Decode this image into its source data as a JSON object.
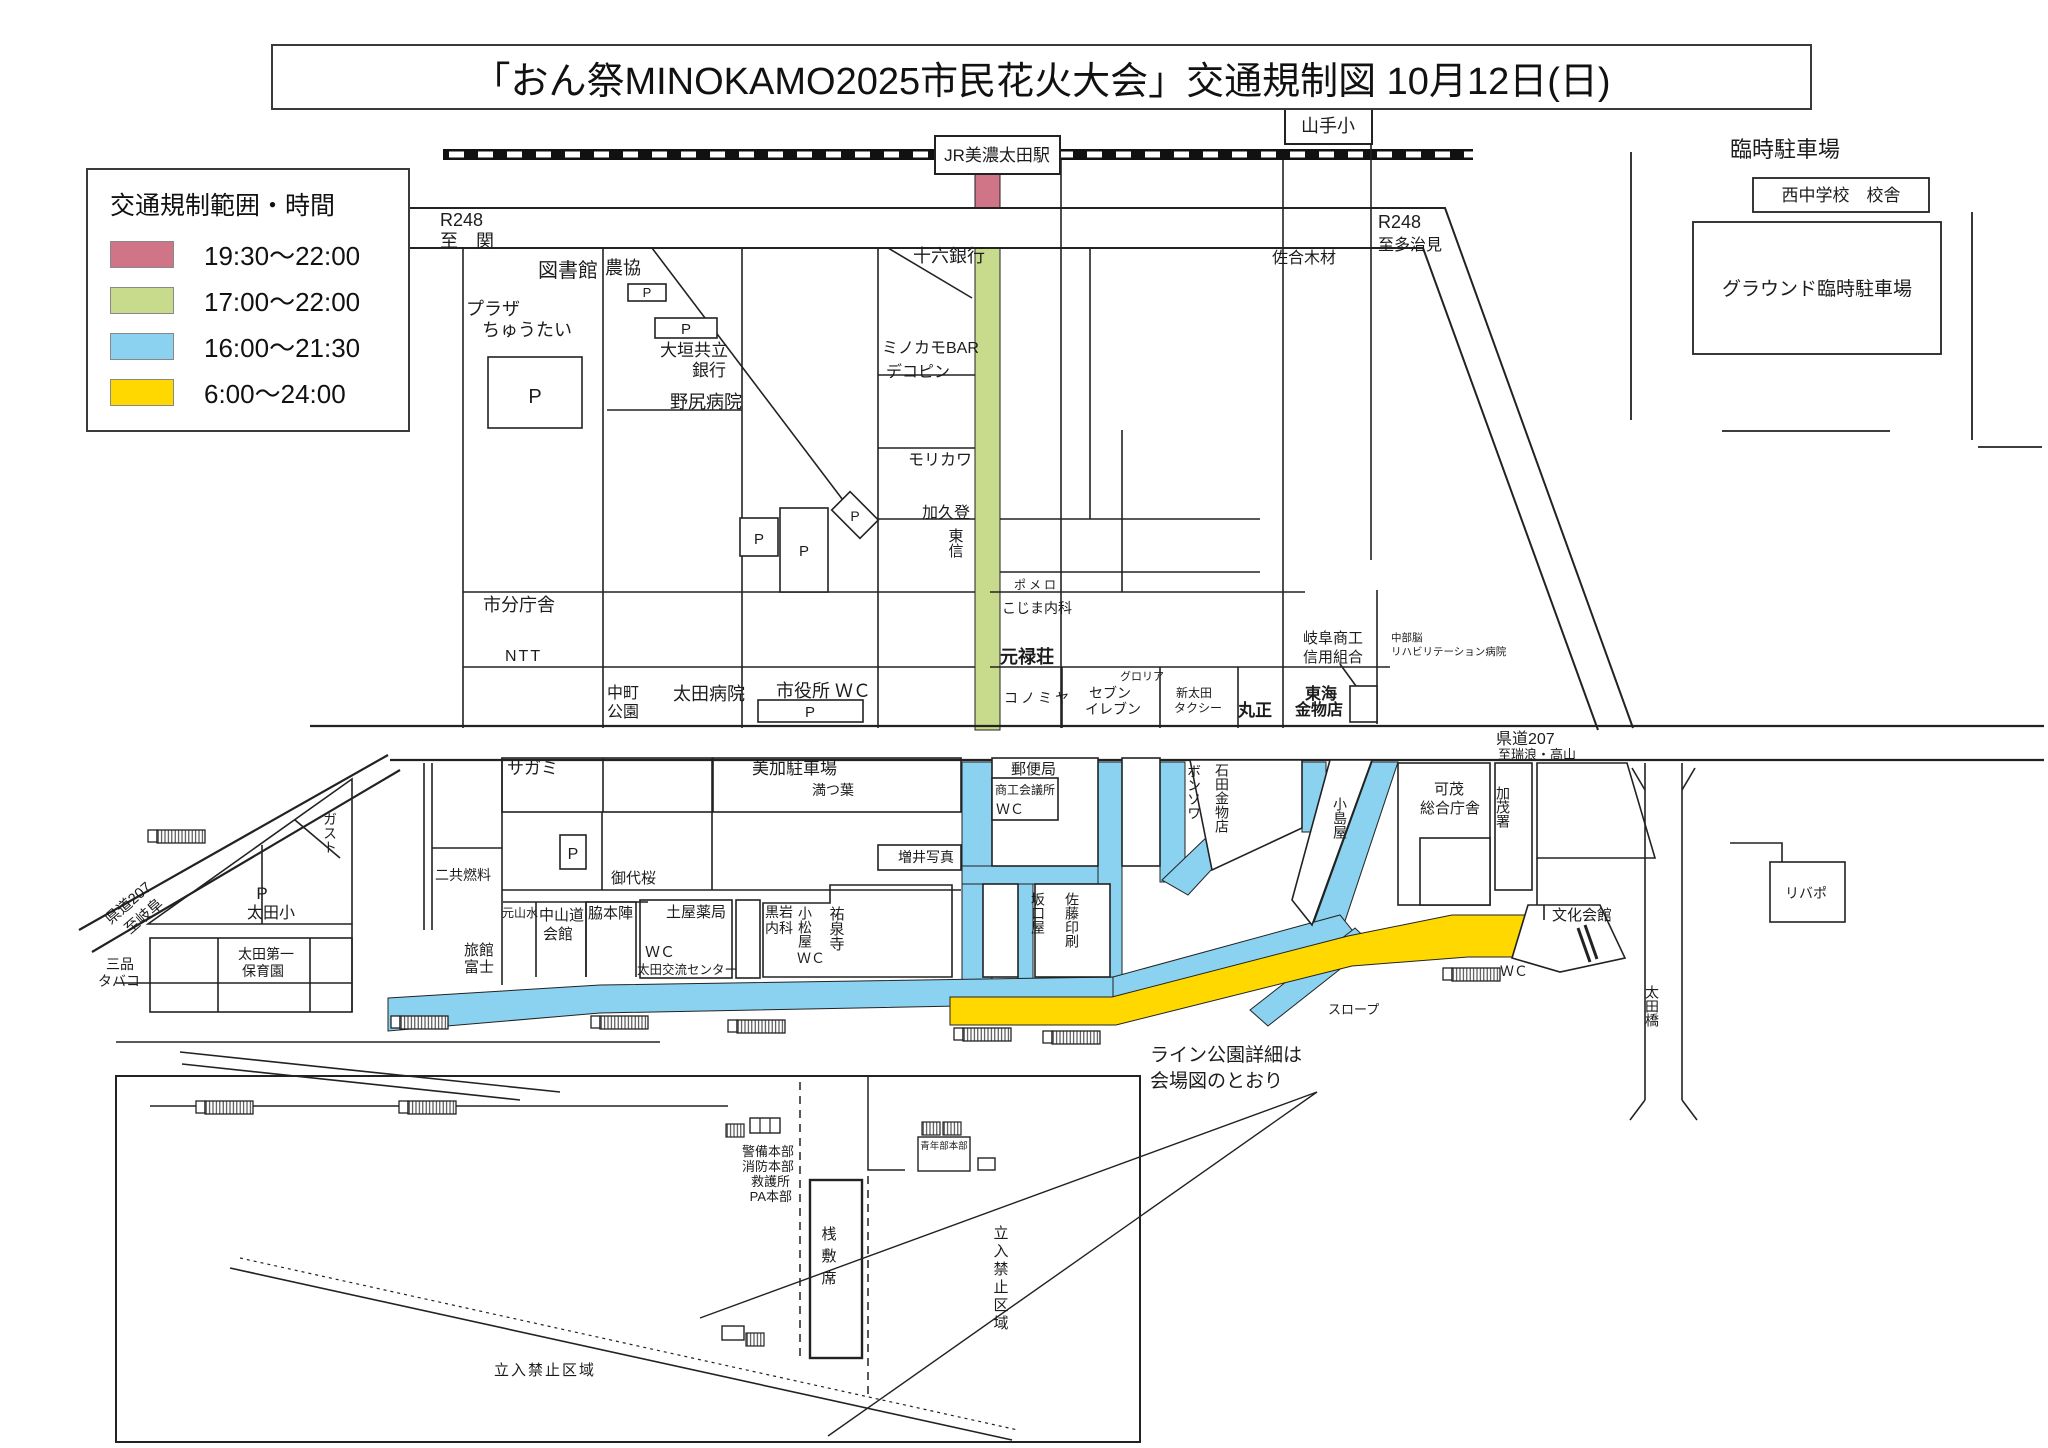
{
  "title": "「おん祭MINOKAMO2025市民花火大会」交通規制図 10月12日(日)",
  "legend": {
    "title": "交通規制範囲・時間",
    "items": [
      {
        "color": "#cf7587",
        "label": "19:30〜22:00"
      },
      {
        "color": "#c8da8c",
        "label": "17:00〜22:00"
      },
      {
        "color": "#8bd2f0",
        "label": "16:00〜21:30"
      },
      {
        "color": "#ffd800",
        "label": "6:00〜24:00"
      }
    ]
  },
  "colors": {
    "red": "#cf7587",
    "green": "#c8da8c",
    "blue": "#8bd2f0",
    "yellow": "#ffd800",
    "line": "#1f1f1f"
  },
  "labels": {
    "station": "JR美濃太田駅",
    "yamate_sho": "山手小",
    "r248": "R248",
    "to_seki": "至　関",
    "to_tajimi": "至多治見",
    "kendo207": "県道207",
    "to_mizunami": "至瑞浪・高山",
    "to_gifu": "至岐阜",
    "toshokan": "図書館",
    "nokyo": "農協",
    "p": "P",
    "plaza1": "プラザ",
    "plaza2": "ちゅうたい",
    "ogaki1": "大垣共立",
    "ogaki2": "銀行",
    "nojiri": "野尻病院",
    "juroku": "十六銀行",
    "minokamo_bar": "ミノカモBAR",
    "dekopin": "デコピン",
    "morikawa": "モリカワ",
    "kakuto": "加久登",
    "toshin": "東信",
    "shibunchosha": "市分庁舎",
    "ntt": "NTT",
    "nakamachi1": "中町",
    "nakamachi2": "公園",
    "ota_byoin": "太田病院",
    "shiyakusho_wc": "市役所 ＷＣ",
    "sago_mokuzai": "佐合木材",
    "pomero": "ポメロ",
    "kojima_naika": "こじま内科",
    "genrokuso": "元禄荘",
    "konomiya": "コノミヤ",
    "gloria": "グロリア",
    "seven1": "セブン",
    "seven2": "イレブン",
    "shin_ota1": "新太田",
    "shin_ota2": "タクシー",
    "marusho": "丸正",
    "tokai1": "東海",
    "tokai2": "金物店",
    "gifu_shoko1": "岐阜商工",
    "gifu_shoko2": "信用組合",
    "chubu1": "中部脳",
    "chubu2": "リハビリテーション病院",
    "rinji_chushajo": "臨時駐車場",
    "nishi_chu": "西中学校　校舎",
    "ground": "グラウンド臨時駐車場",
    "sagami": "サガミ",
    "mika_chushajo": "美加駐車場",
    "mitsuba": "満つ葉",
    "masui_shashin": "増井写真",
    "miyozakura": "御代桜",
    "nikyo_nenryo": "二共燃料",
    "gasuto": "ガスト",
    "ota_sho": "太田小",
    "mishina1": "三品",
    "mishina2": "タバコ",
    "hoikuen1": "太田第一",
    "hoikuen2": "保育園",
    "ryokan1": "旅館",
    "ryokan2": "富士",
    "motoyamasui": "元山水",
    "nakasendo1": "中山道",
    "nakasendo2": "会館",
    "wakihonjin": "脇本陣",
    "tsuchiya": "土屋薬局",
    "wc": "ＷＣ",
    "koryu_center": "太田交流センター",
    "kuroiwa1": "黒岩",
    "kuroiwa2": "内科",
    "komatsuya": "小松屋",
    "yusenji": "祐泉寺",
    "sakaguchiya": "坂口屋",
    "sato_insatsu": "佐藤印刷",
    "yubinkyoku": "郵便局",
    "shoko_kaigisho": "商工会議所",
    "bonsowa": "ボンソワ",
    "ishida": "石田金物店",
    "kojimaya": "小島屋",
    "kamo1": "可茂",
    "kamo2": "総合庁舎",
    "kamosho": "加茂署",
    "bunka_kaikan": "文化会館",
    "ribapo": "リバポ",
    "slope": "スロープ",
    "otabashi": "太田橋",
    "line_park1": "ライン公園詳細は",
    "line_park2": "会場図のとおり",
    "keibi": "警備本部",
    "shobo": "消防本部",
    "kyugo": "救護所",
    "pa_honbu": "PA本部",
    "seinenbu": "青年部本部",
    "sajikiseki": "桟敷席",
    "tachiiri": "立入禁止区域"
  }
}
